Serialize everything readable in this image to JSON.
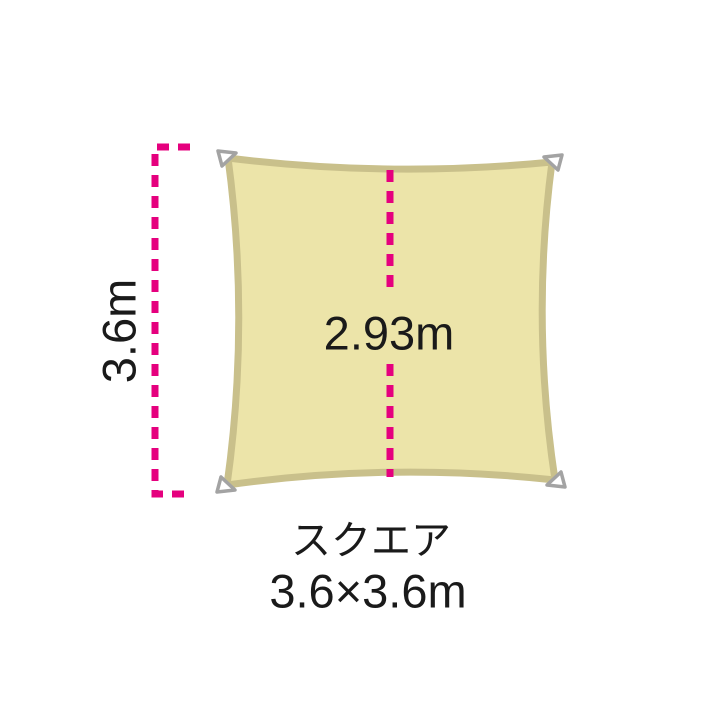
{
  "diagram": {
    "shape_name": "スクエア",
    "shape_size": "3.6×3.6m",
    "dimensions": {
      "side_length": "3.6m",
      "inner_span": "2.93m"
    },
    "colors": {
      "background": "#ffffff",
      "sail_fill": "#ece4a9",
      "sail_border": "#c9c08b",
      "dimension_line": "#e5007e",
      "corner_loop_fill": "#ffffff",
      "corner_loop_stroke": "#a3a3a3",
      "text": "#1a1a1a"
    },
    "icons": {
      "corner_loops": "corner-loop-triangle-icon",
      "dimension_style": "dashed-magenta-line"
    }
  }
}
